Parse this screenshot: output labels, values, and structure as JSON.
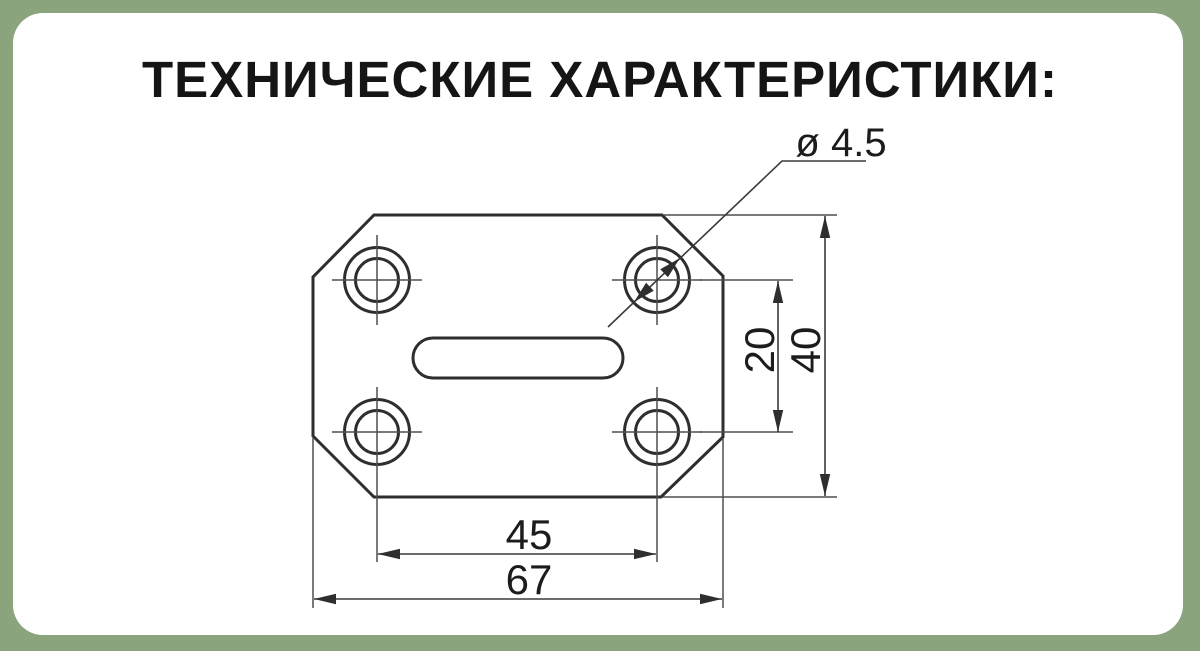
{
  "title": "ТЕХНИЧЕСКИЕ ХАРАКТЕРИСТИКИ:",
  "drawing": {
    "description": "Чертёж прямоугольной пластины со скошенными углами, четырьмя отверстиями и центральным пазом",
    "dimensions": {
      "hole_diameter": "ø 4.5",
      "hole_spacing_vertical": "20",
      "plate_height": "40",
      "hole_spacing_horizontal": "45",
      "plate_width": "67"
    }
  },
  "colors": {
    "background": "#8CA47D",
    "card": "#FFFFFF",
    "line_bold": "#2E2E2E",
    "line_thin": "#4E4E4E",
    "text": "#1C1C1C"
  }
}
